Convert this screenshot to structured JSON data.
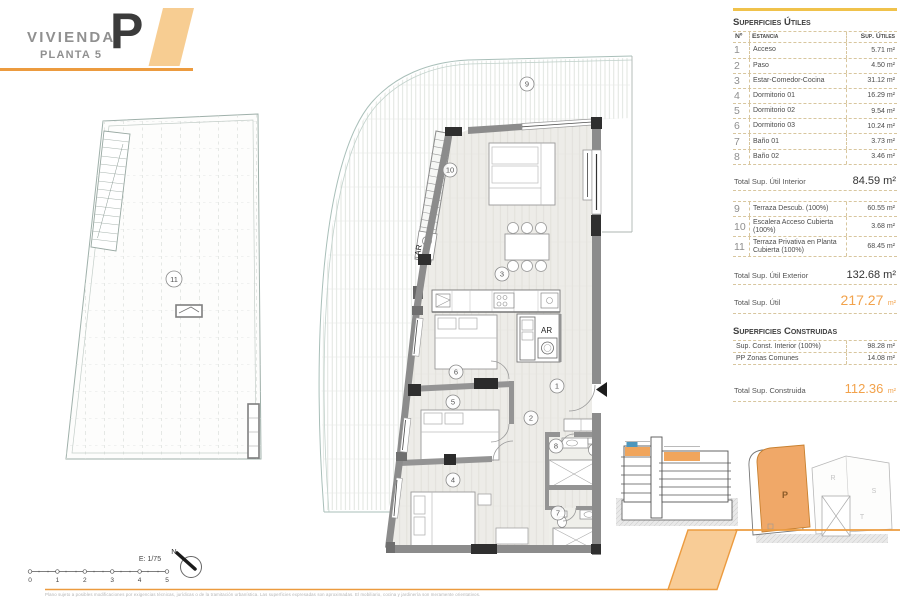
{
  "title": {
    "project": "VIVIENDA",
    "floor": "PLANTA 5",
    "letter": "P"
  },
  "sidebar": {
    "utiles": {
      "heading": "Superficies Útiles",
      "col_n": "Nº",
      "col_name": "Estancia",
      "col_area": "Sup. Útiles",
      "rows": [
        {
          "n": "1",
          "name": "Acceso",
          "area": "5.71 m²"
        },
        {
          "n": "2",
          "name": "Paso",
          "area": "4.50 m²"
        },
        {
          "n": "3",
          "name": "Estar-Comedor-Cocina",
          "area": "31.12 m²"
        },
        {
          "n": "4",
          "name": "Dormitorio 01",
          "area": "16.29 m²"
        },
        {
          "n": "5",
          "name": "Dormitorio 02",
          "area": "9.54 m²"
        },
        {
          "n": "6",
          "name": "Dormitorio 03",
          "area": "10.24 m²"
        },
        {
          "n": "7",
          "name": "Baño 01",
          "area": "3.73 m²"
        },
        {
          "n": "8",
          "name": "Baño 02",
          "area": "3.46 m²"
        }
      ],
      "total_label": "Total Sup. Útil Interior",
      "total_value": "84.59 m²"
    },
    "exterior": {
      "rows": [
        {
          "n": "9",
          "name": "Terraza Descub. (100%)",
          "area": "60.55 m²"
        },
        {
          "n": "10",
          "name": "Escalera Acceso Cubierta (100%)",
          "area": "3.68 m²"
        },
        {
          "n": "11",
          "name": "Terraza Privativa en Planta Cubierta (100%)",
          "area": "68.45 m²"
        }
      ],
      "total_ext_label": "Total Sup. Útil Exterior",
      "total_ext_value": "132.68 m²",
      "total_label": "Total Sup. Útil",
      "total_value": "217.27",
      "total_unit": "m²"
    },
    "construidas": {
      "heading": "Superficies Construidas",
      "rows": [
        {
          "name": "Sup. Const. Interior (100%)",
          "area": "98.28 m²"
        },
        {
          "name": "PP Zonas Comunes",
          "area": "14.08 m²"
        }
      ],
      "total_label": "Total Sup. Construida",
      "total_value": "112.36",
      "total_unit": "m²"
    }
  },
  "plan": {
    "room_numbers": [
      "1",
      "2",
      "3",
      "4",
      "5",
      "6",
      "7",
      "8",
      "9",
      "10",
      "11"
    ],
    "ar_label": "AR"
  },
  "keyplan": {
    "unit": "P",
    "neighbors": [
      "R",
      "S",
      "T"
    ]
  },
  "scalebar": {
    "label": "E: 1/75",
    "north": "N",
    "ticks": [
      "0",
      "1",
      "2",
      "3",
      "4",
      "5"
    ]
  },
  "footer": {
    "disclaimer": "Plano sujeto a posibles modificaciones por exigencias técnicas, jurídicas o de la tramitación urbanística. Las superficies expresadas son aproximadas. El mobiliario, cocina y jardinería son meramente orientativos."
  },
  "colors": {
    "accent": "#EC9B3F",
    "accent_light": "#F8CC96",
    "unit_fill": "#F0A868",
    "section_blue": "#4E97BD",
    "total_text": "#F2A24B",
    "topline_yellow": "#F0C24B"
  }
}
